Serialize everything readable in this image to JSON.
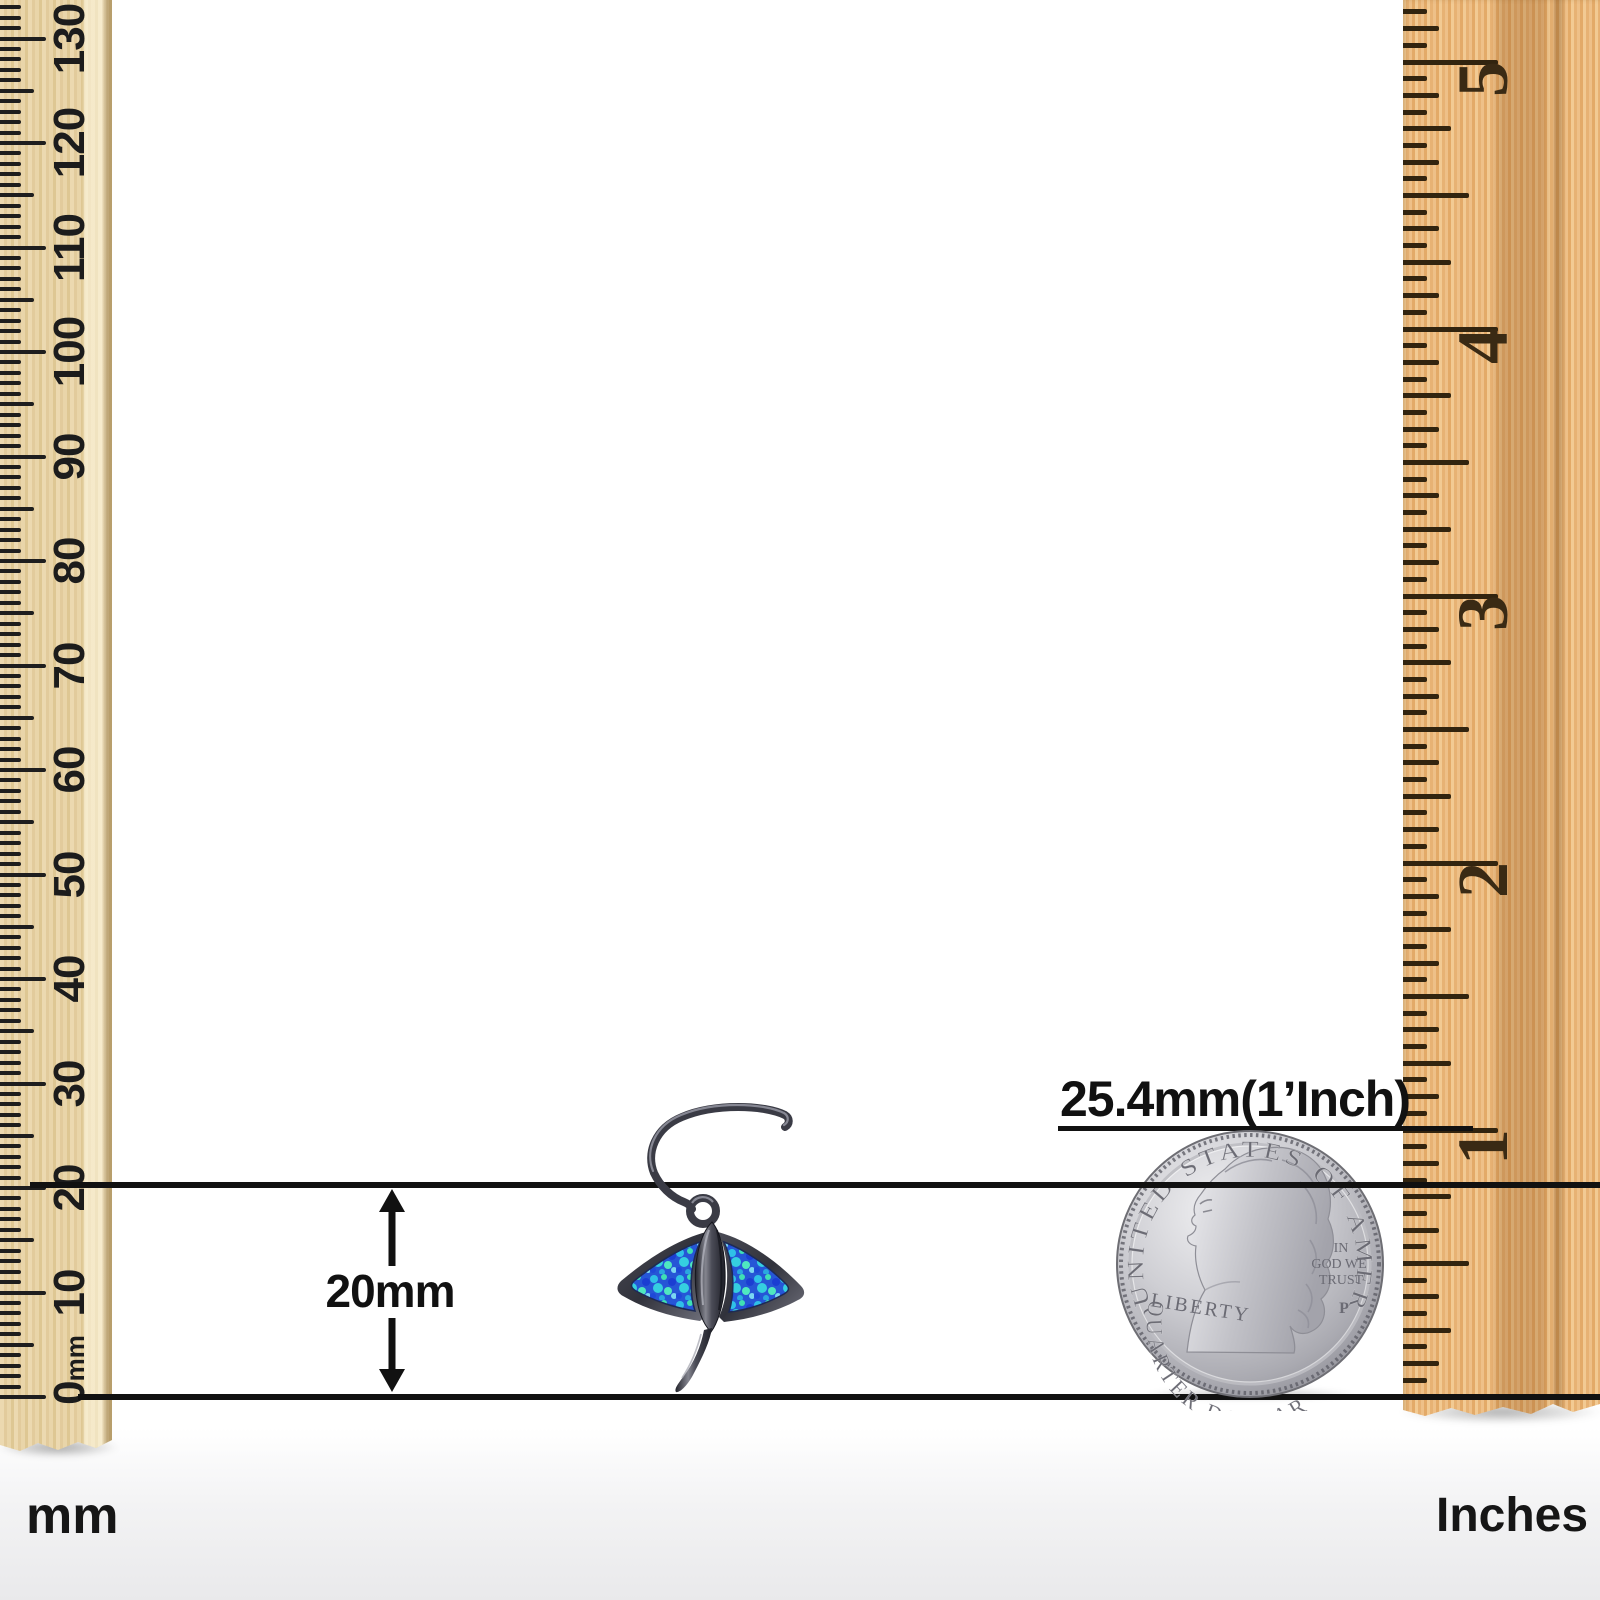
{
  "image_type": "jewelry-size-diagram",
  "annotations": {
    "height_arrow_label": "20mm",
    "inch_reference_label": "25.4mm(1’Inch)"
  },
  "rulers": {
    "left": {
      "unit_label": "mm",
      "tick_labels": [
        "0mm",
        "10",
        "20",
        "30",
        "40",
        "50",
        "60",
        "70",
        "80",
        "90",
        "100",
        "110",
        "120",
        "130"
      ]
    },
    "right": {
      "unit_label": "Inches",
      "tick_labels": [
        "1",
        "2",
        "3",
        "4",
        "5"
      ]
    }
  },
  "coin": {
    "top_text": "UNITED STATES OF AMERICA",
    "left_text": "LIBERTY",
    "motto_lines": [
      "IN",
      "GOD WE",
      "TRUST"
    ],
    "mint_mark": "P",
    "bottom_text": "QUARTER DOLLAR"
  },
  "colors": {
    "line": "#111111",
    "tick_left": "#1e1e1e",
    "tick_right": "#32240f",
    "left_ruler_wood": "#e9d5a9",
    "right_ruler_wood": "#eaba7d",
    "metal": "#3a3b45",
    "metal_highlight": "#8f909b",
    "opal_blue": "#2656d6",
    "opal_cyan": "#2fc0e8",
    "opal_aqua": "#3fe0b4",
    "coin_silver": "#c9c9cd",
    "coin_engraving": "#6b6b74"
  }
}
